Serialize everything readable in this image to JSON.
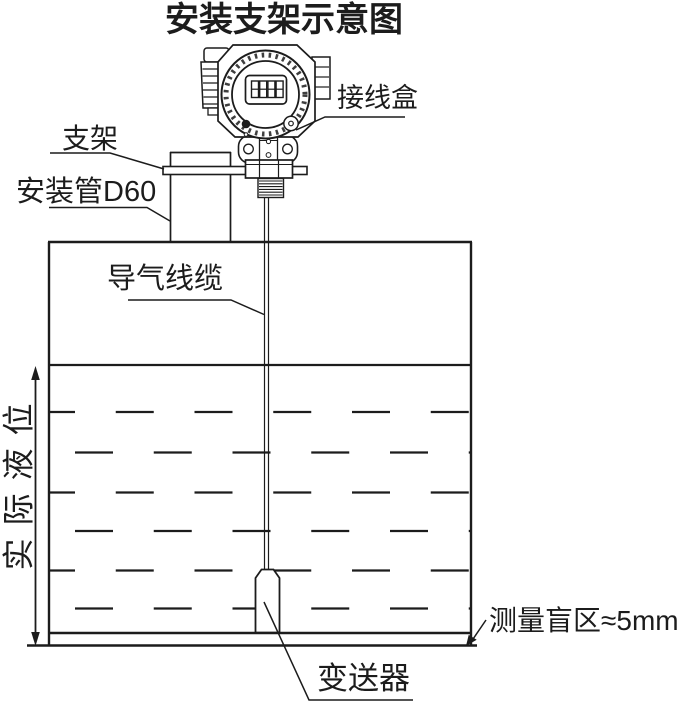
{
  "diagram": {
    "title": "安装支架示意图",
    "labels": {
      "junction_box": "接线盒",
      "bracket": "支架",
      "mounting_pipe": "安装管D60",
      "air_cable": "导气线缆",
      "actual_level": "实际液位",
      "blind_zone": "测量盲区≈5mm",
      "transmitter": "变送器"
    },
    "colors": {
      "line": "#1c1c1c",
      "background": "#ffffff"
    }
  }
}
